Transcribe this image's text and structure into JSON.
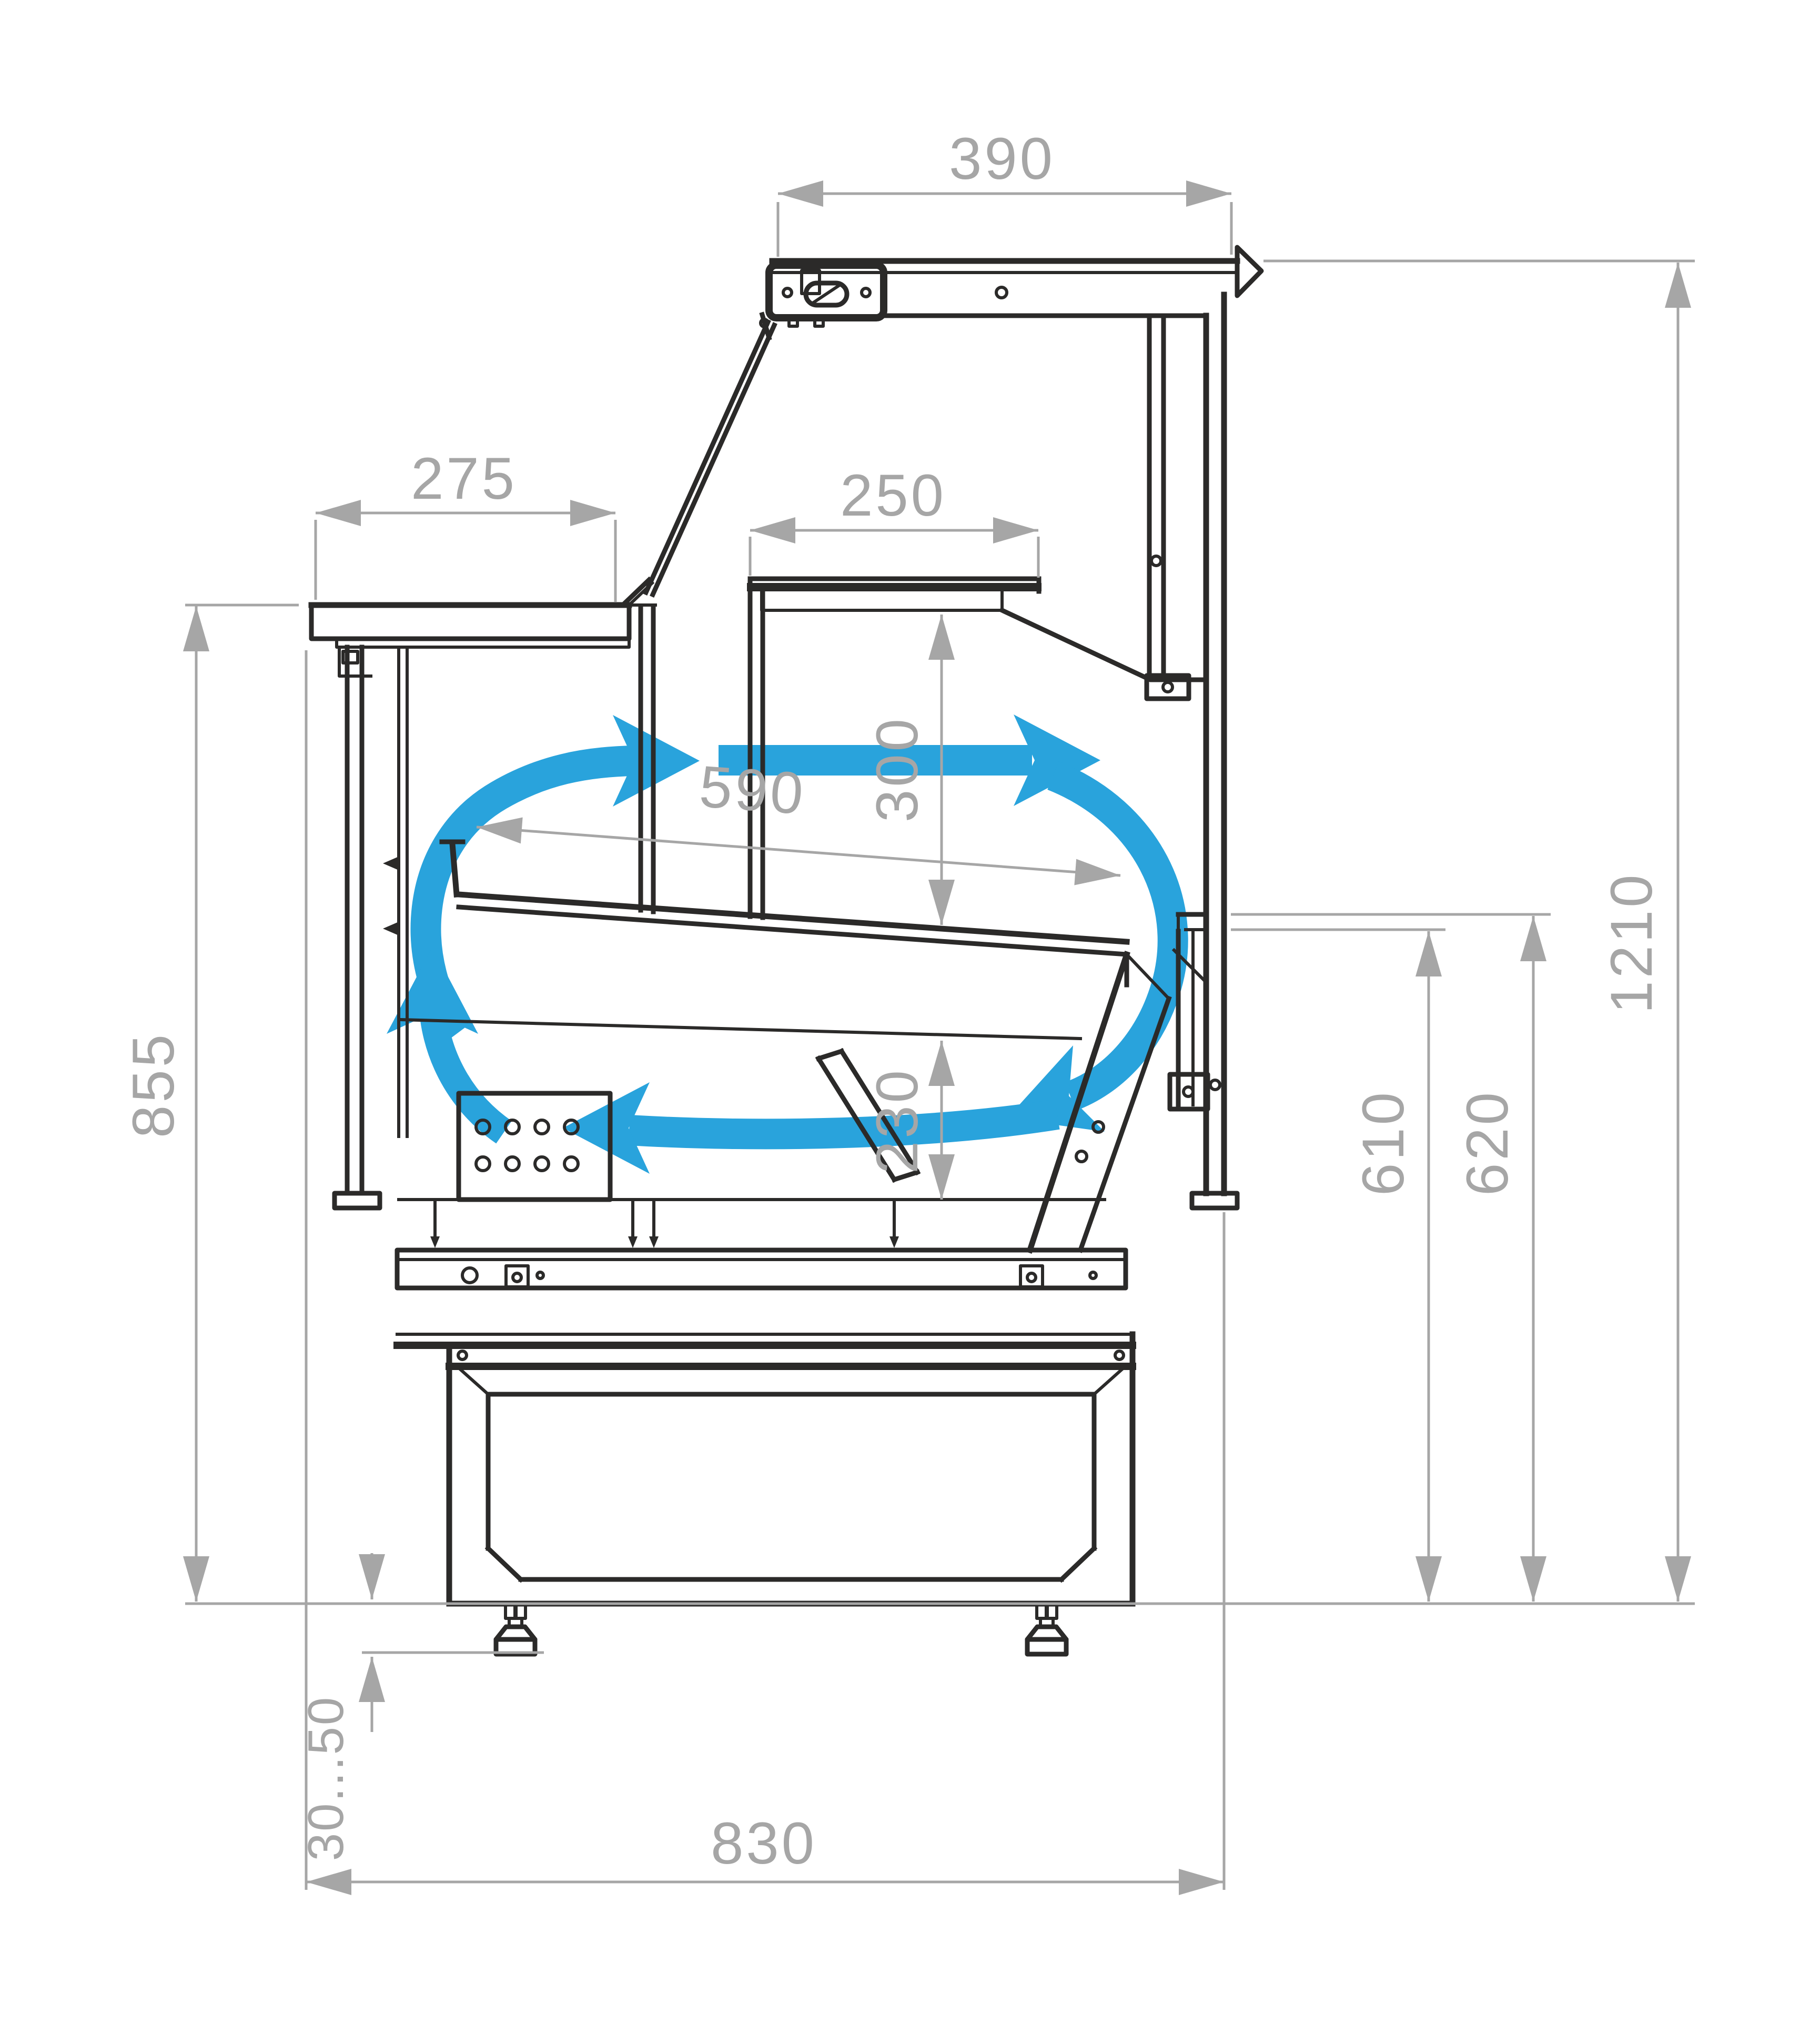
{
  "drawing": {
    "type": "technical-cross-section",
    "subject": "Refrigerated serve-over display counter — side section with air circulation arrows",
    "units": "mm"
  },
  "colors": {
    "outline": "#2B2A29",
    "dimension": "#A6A6A6",
    "airflow": "#29A3DC",
    "background": "#FFFFFF"
  },
  "dimensions": {
    "canopy_depth": "390",
    "worktop_depth": "275",
    "shelf_depth": "250",
    "display_opening_height": "300",
    "deck_depth": "590",
    "well_depth": "230",
    "worktop_height": "855",
    "rear_deck_height": "610",
    "rear_edge_height": "620",
    "overall_height": "1210",
    "leg_adjustment": "30...50",
    "base_depth": "830"
  }
}
